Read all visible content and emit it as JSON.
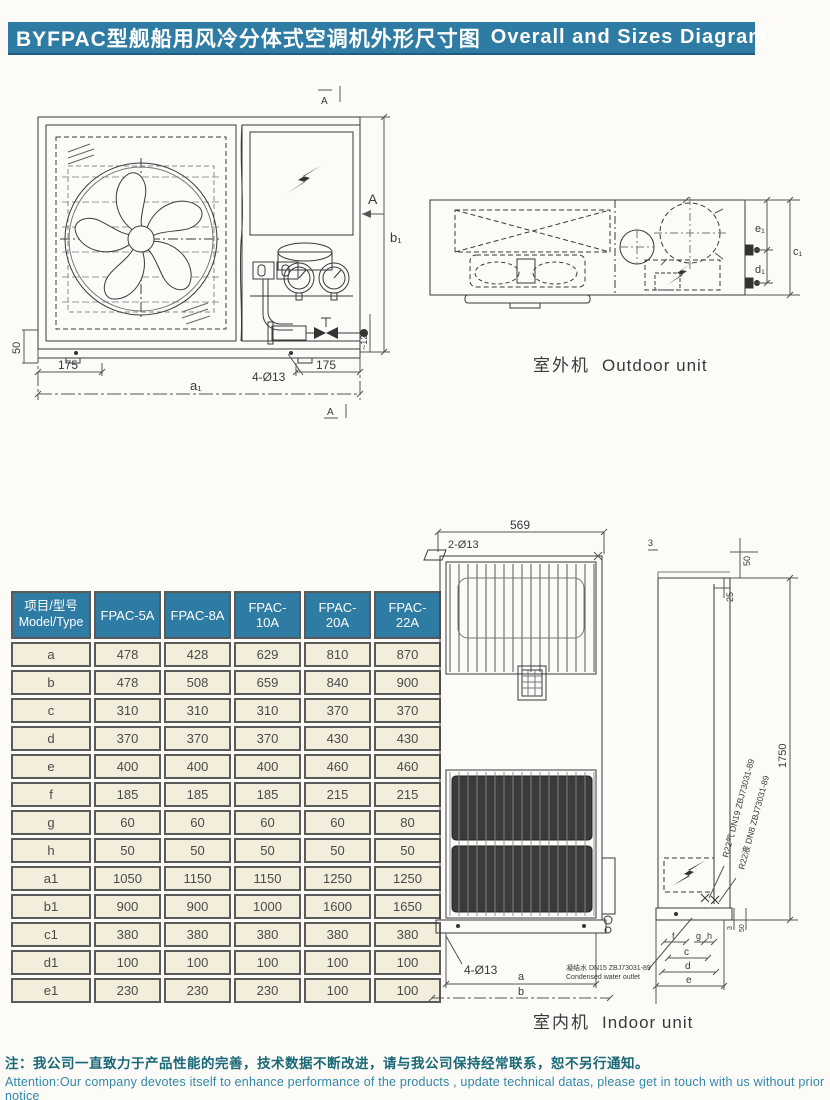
{
  "page": {
    "title_zh": "BYFPAC型舰船用风冷分体式空调机外形尺寸图",
    "title_en": "Overall and Sizes Diagram"
  },
  "colors": {
    "banner": "#2e7ba3",
    "table_header": "#2e7ba3",
    "table_cell": "#f2eedb",
    "note_zh": "#186878",
    "note_en": "#2f88aa",
    "line": "#3a3a3a"
  },
  "outdoor": {
    "label_zh": "室外机",
    "label_en": "Outdoor unit",
    "front": {
      "section_top": "A",
      "section_bottom": "A",
      "section_right": "A",
      "dim_a1": "a₁",
      "dim_b1": "b₁",
      "dim_175_left": "175",
      "dim_175_right": "175",
      "dim_holes": "4-Ø13",
      "dim_50": "50",
      "dim_120": "~120"
    },
    "top": {
      "dim_e1": "e₁",
      "dim_d1": "d₁",
      "dim_c1": "c₁"
    }
  },
  "indoor": {
    "label_zh": "室内机",
    "label_en": "Indoor unit",
    "front": {
      "dim_569": "569",
      "holes_top": "2-Ø13",
      "holes_bottom": "4-Ø13",
      "dim_a": "a",
      "dim_b": "b",
      "drain_zh": "凝结水 DN15 ZBJ73031-89",
      "drain_en": "Condensed water outlet"
    },
    "side": {
      "dim_3": "3",
      "dim_50": "50",
      "dim_25": "25",
      "dim_1750": "1750",
      "pipe_gas": "R22气 DN19 ZBJ73031-89",
      "pipe_liquid": "R22液 DN8 ZBJ73031-89",
      "dim_f": "f",
      "dim_g": "g",
      "dim_h": "h",
      "dim_c": "c",
      "dim_d": "d",
      "dim_e": "e",
      "dim_bottom_3": "3",
      "dim_bottom_50": "50"
    }
  },
  "table": {
    "header": {
      "zh": "项目/型号",
      "en": "Model/Type"
    },
    "models": [
      "FPAC-5A",
      "FPAC-8A",
      "FPAC-10A",
      "FPAC-20A",
      "FPAC-22A"
    ],
    "rows": [
      {
        "param": "a",
        "values": [
          "478",
          "428",
          "629",
          "810",
          "870"
        ]
      },
      {
        "param": "b",
        "values": [
          "478",
          "508",
          "659",
          "840",
          "900"
        ]
      },
      {
        "param": "c",
        "values": [
          "310",
          "310",
          "310",
          "370",
          "370"
        ]
      },
      {
        "param": "d",
        "values": [
          "370",
          "370",
          "370",
          "430",
          "430"
        ]
      },
      {
        "param": "e",
        "values": [
          "400",
          "400",
          "400",
          "460",
          "460"
        ]
      },
      {
        "param": "f",
        "values": [
          "185",
          "185",
          "185",
          "215",
          "215"
        ]
      },
      {
        "param": "g",
        "values": [
          "60",
          "60",
          "60",
          "60",
          "80"
        ]
      },
      {
        "param": "h",
        "values": [
          "50",
          "50",
          "50",
          "50",
          "50"
        ]
      },
      {
        "param": "a1",
        "values": [
          "1050",
          "1150",
          "1150",
          "1250",
          "1250"
        ]
      },
      {
        "param": "b1",
        "values": [
          "900",
          "900",
          "1000",
          "1600",
          "1650"
        ]
      },
      {
        "param": "c1",
        "values": [
          "380",
          "380",
          "380",
          "380",
          "380"
        ]
      },
      {
        "param": "d1",
        "values": [
          "100",
          "100",
          "100",
          "100",
          "100"
        ]
      },
      {
        "param": "e1",
        "values": [
          "230",
          "230",
          "230",
          "100",
          "100"
        ]
      }
    ]
  },
  "notes": {
    "zh": "注：我公司一直致力于产品性能的完善，技术数据不断改进，请与我公司保持经常联系，恕不另行通知。",
    "en": "Attention:Our company devotes itself to enhance performance of the products , update technical datas, please get in touch with us without prior notice"
  }
}
